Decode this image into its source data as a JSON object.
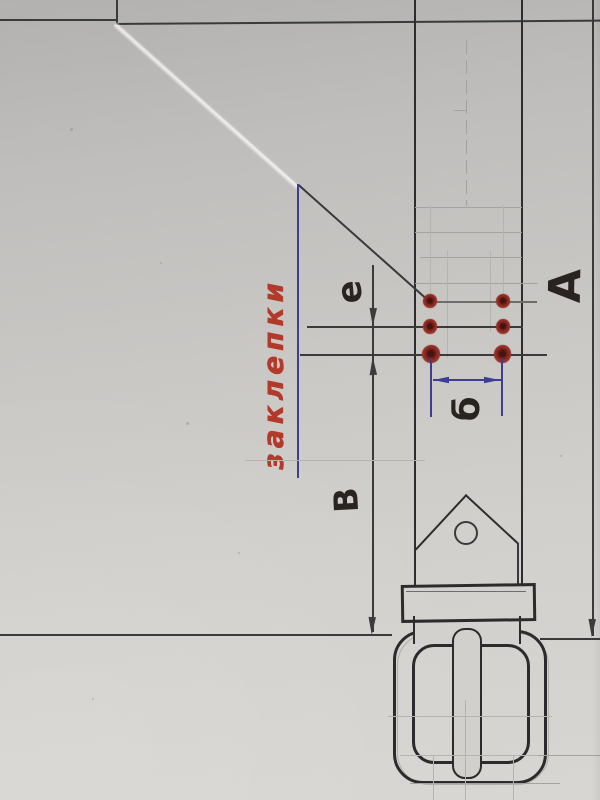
{
  "labels": {
    "rivets_label": "заклепки",
    "dim_e": "е",
    "dim_b": "б",
    "dim_v": "В",
    "dim_a": "А"
  },
  "rivets": {
    "count": 6,
    "rows": 3,
    "columns": 2
  },
  "colors": {
    "paper": "#cac8c5",
    "pencil": "#3a3a3c",
    "blue_ink": "#3e3d94",
    "red_label": "#b23a2b",
    "marker_dark": "#2a2421",
    "rivet_red": "#a63a2d"
  }
}
